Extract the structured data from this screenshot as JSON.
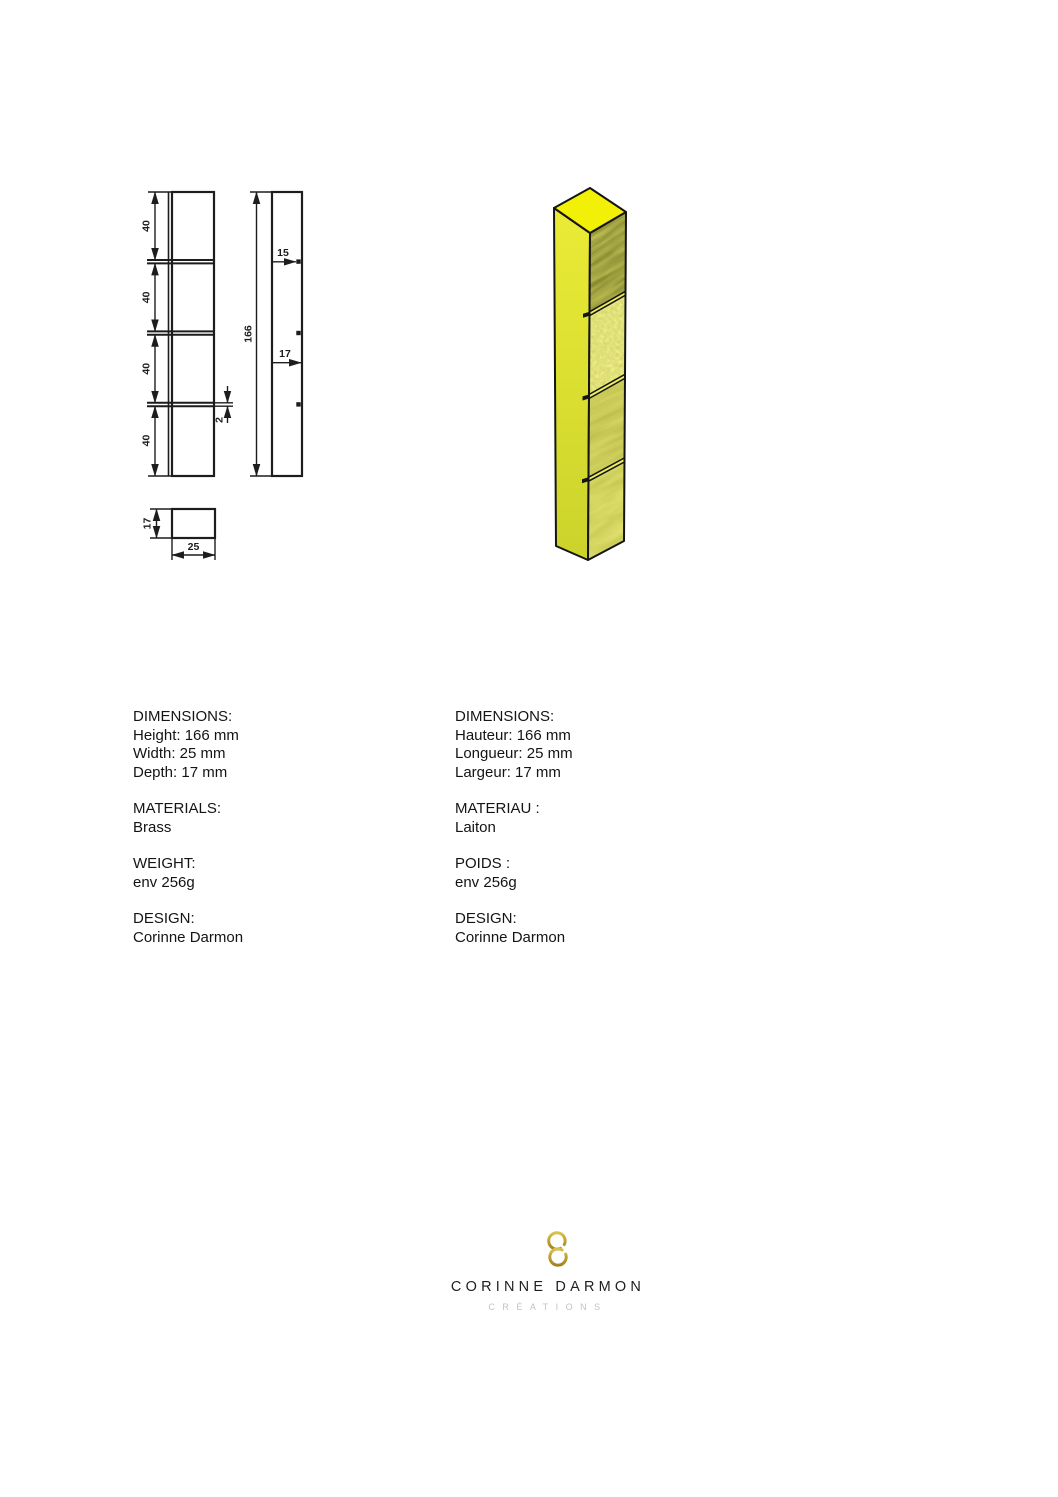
{
  "drawing": {
    "front_view": {
      "segment_labels": [
        "40",
        "40",
        "40",
        "40"
      ],
      "groove_label": "2"
    },
    "side_view": {
      "height_label": "166",
      "step_label": "15",
      "depth_label": "17"
    },
    "section_view": {
      "depth_label": "17",
      "width_label": "25"
    }
  },
  "specs_en": {
    "dimensions_heading": "DIMENSIONS:",
    "dimension_lines": [
      "Height: 166 mm",
      "Width: 25 mm",
      "Depth: 17 mm"
    ],
    "materials_heading": "MATERIALS:",
    "materials_value": "Brass",
    "weight_heading": "WEIGHT:",
    "weight_value": "env 256g",
    "design_heading": "DESIGN:",
    "design_value": "Corinne Darmon"
  },
  "specs_fr": {
    "dimensions_heading": "DIMENSIONS:",
    "dimension_lines": [
      "Hauteur: 166 mm",
      "Longueur: 25 mm",
      "Largeur: 17 mm"
    ],
    "materials_heading": "MATERIAU :",
    "materials_value": "Laiton",
    "weight_heading": "POIDS :",
    "weight_value": "env 256g",
    "design_heading": "DESIGN:",
    "design_value": "Corinne Darmon"
  },
  "logo": {
    "brand": "CORINNE DARMON",
    "tagline": "CRÉATIONS"
  },
  "colors": {
    "line": "#1d1d1d",
    "top_face": "#f3f007",
    "left_face_top": "#ebeb36",
    "left_face_bottom": "#cbd32b",
    "groove": "#ecec5e",
    "gold_light": "#d9c14b",
    "gold_dark": "#a2831c"
  }
}
